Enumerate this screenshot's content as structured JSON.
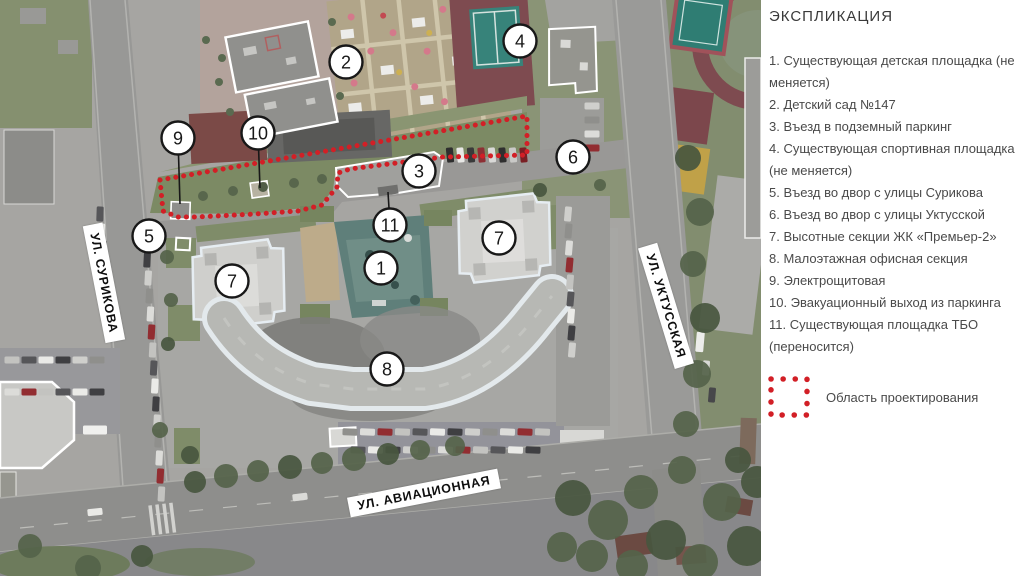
{
  "colors": {
    "accent_red": "#d21f26",
    "marker_ink": "#181818",
    "legend_text": "#4a4a4a"
  },
  "legend": {
    "title": "ЭКСПЛИКАЦИЯ",
    "items": [
      "1. Существующая детская площадка (не меняется)",
      "2. Детский сад №147",
      "3. Въезд в подземный паркинг",
      "4. Существующая спортивная площадка (не меняется)",
      "5. Въезд во двор с улицы Сурикова",
      "6. Въезд во двор с улицы Уктусской",
      "7. Высотные секции ЖК «Премьер-2»",
      "8. Малоэтажная офисная секция",
      "9. Электрощитовая",
      "10. Эвакуационный выход из паркинга",
      "11. Существующая площадка ТБО (переносится)"
    ],
    "area_label": "Область проектирования"
  },
  "map": {
    "street_labels": [
      {
        "id": "surikova",
        "text": "УЛ. СУРИКОВА",
        "x": 104,
        "y": 283,
        "angle": 79
      },
      {
        "id": "uktusskaya",
        "text": "УЛ. УКТУССКАЯ",
        "x": 666,
        "y": 306,
        "angle": 73
      },
      {
        "id": "aviatsionnaya",
        "text": "УЛ. АВИАЦИОННАЯ",
        "x": 424,
        "y": 493,
        "angle": -11
      }
    ],
    "markers": [
      {
        "n": "1",
        "x": 381,
        "y": 268
      },
      {
        "n": "2",
        "x": 346,
        "y": 62
      },
      {
        "n": "3",
        "x": 419,
        "y": 171
      },
      {
        "n": "4",
        "x": 520,
        "y": 41
      },
      {
        "n": "5",
        "x": 149,
        "y": 236
      },
      {
        "n": "6",
        "x": 573,
        "y": 157
      },
      {
        "n": "7",
        "x": 232,
        "y": 281
      },
      {
        "n": "7",
        "x": 499,
        "y": 238
      },
      {
        "n": "8",
        "x": 387,
        "y": 369
      },
      {
        "n": "9",
        "x": 178,
        "y": 138,
        "leader": [
          180,
          204
        ]
      },
      {
        "n": "10",
        "x": 258,
        "y": 133,
        "leader": [
          260,
          188
        ]
      },
      {
        "n": "11",
        "x": 390,
        "y": 225,
        "leader": [
          388,
          192
        ]
      }
    ],
    "boundary": [
      [
        160,
        180
      ],
      [
        527,
        116
      ],
      [
        527,
        155
      ],
      [
        443,
        157
      ],
      [
        350,
        169
      ],
      [
        338,
        173
      ],
      [
        337,
        187
      ],
      [
        322,
        205
      ],
      [
        298,
        211
      ],
      [
        255,
        214
      ],
      [
        196,
        217
      ],
      [
        178,
        217
      ],
      [
        163,
        211
      ],
      [
        160,
        180
      ]
    ]
  }
}
